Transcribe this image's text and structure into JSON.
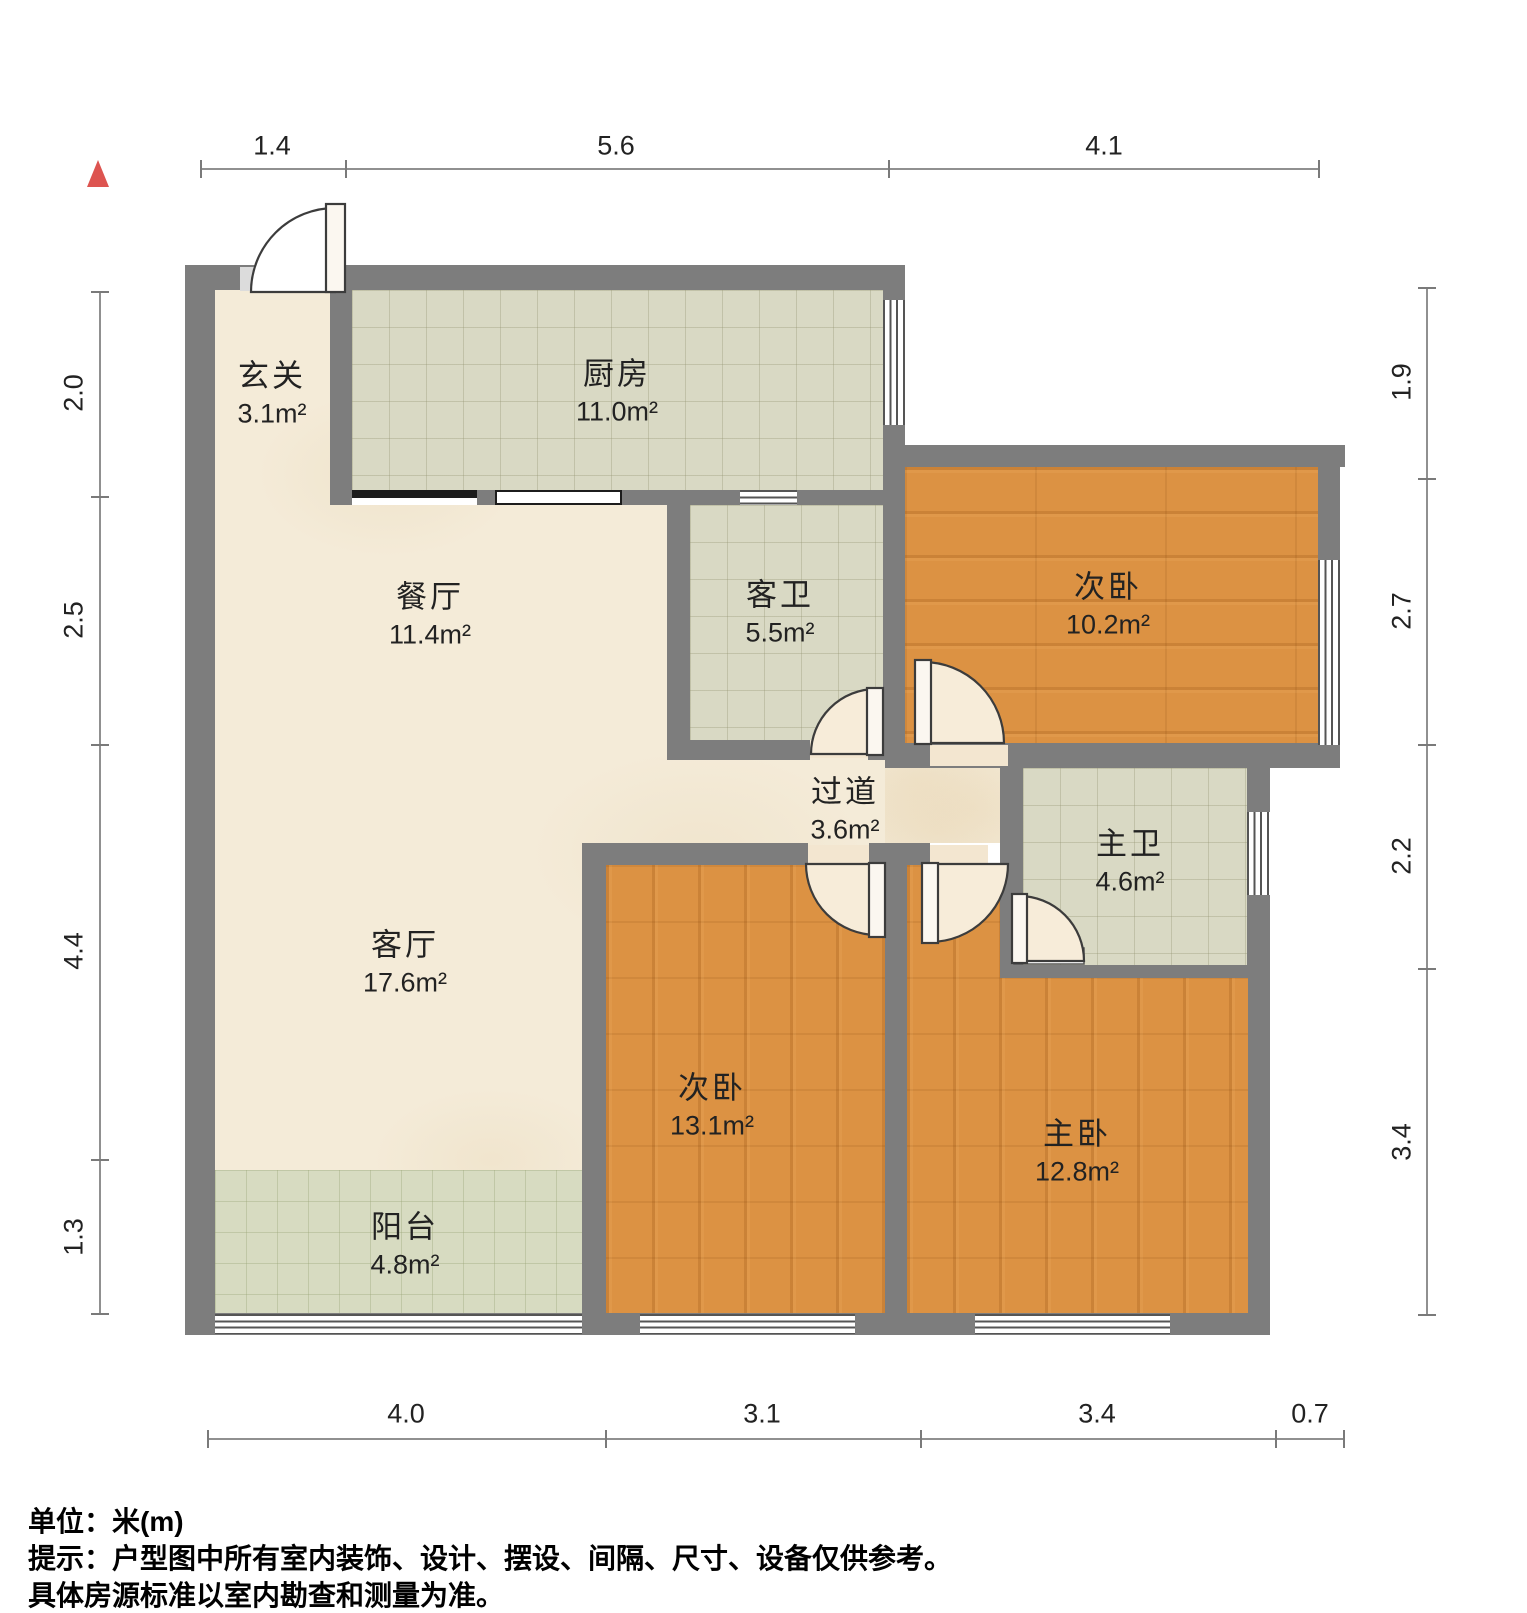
{
  "meta": {
    "type": "residential floor plan",
    "north_indicator": "north-arrow"
  },
  "rooms": [
    {
      "id": "entry",
      "name": "玄关",
      "area": "3.1m²"
    },
    {
      "id": "kitchen",
      "name": "厨房",
      "area": "11.0m²"
    },
    {
      "id": "dining",
      "name": "餐厅",
      "area": "11.4m²"
    },
    {
      "id": "guest-bath",
      "name": "客卫",
      "area": "5.5m²"
    },
    {
      "id": "bedroom-2",
      "name": "次卧",
      "area": "10.2m²"
    },
    {
      "id": "hallway",
      "name": "过道",
      "area": "3.6m²"
    },
    {
      "id": "master-bath",
      "name": "主卫",
      "area": "4.6m²"
    },
    {
      "id": "living",
      "name": "客厅",
      "area": "17.6m²"
    },
    {
      "id": "bedroom-3",
      "name": "次卧",
      "area": "13.1m²"
    },
    {
      "id": "master-bedroom",
      "name": "主卧",
      "area": "12.8m²"
    },
    {
      "id": "balcony",
      "name": "阳台",
      "area": "4.8m²"
    }
  ],
  "dimensions": {
    "unit": "米(m)",
    "top": [
      "1.4",
      "5.6",
      "4.1"
    ],
    "left": [
      "2.0",
      "2.5",
      "4.4",
      "1.3"
    ],
    "right": [
      "1.9",
      "2.7",
      "2.2",
      "3.4"
    ],
    "bottom": [
      "4.0",
      "3.1",
      "3.4",
      "0.7"
    ]
  },
  "footer": {
    "unit_line": "单位：米(m)",
    "tip_line1": "提示：户型图中所有室内装饰、设计、摆设、间隔、尺寸、设备仅供参考。",
    "tip_line2": "具体房源标准以室内勘查和测量为准。"
  },
  "colors": {
    "wall": "#7d7d7d",
    "wood_floor": "#dc9243",
    "tile_floor": "#d9d9c4",
    "marble_floor": "#f4ebd8",
    "balcony_floor": "#d7dbc1",
    "north_arrow": "#dd5450",
    "dimension_text": "#222222",
    "window_line": "#555555"
  }
}
